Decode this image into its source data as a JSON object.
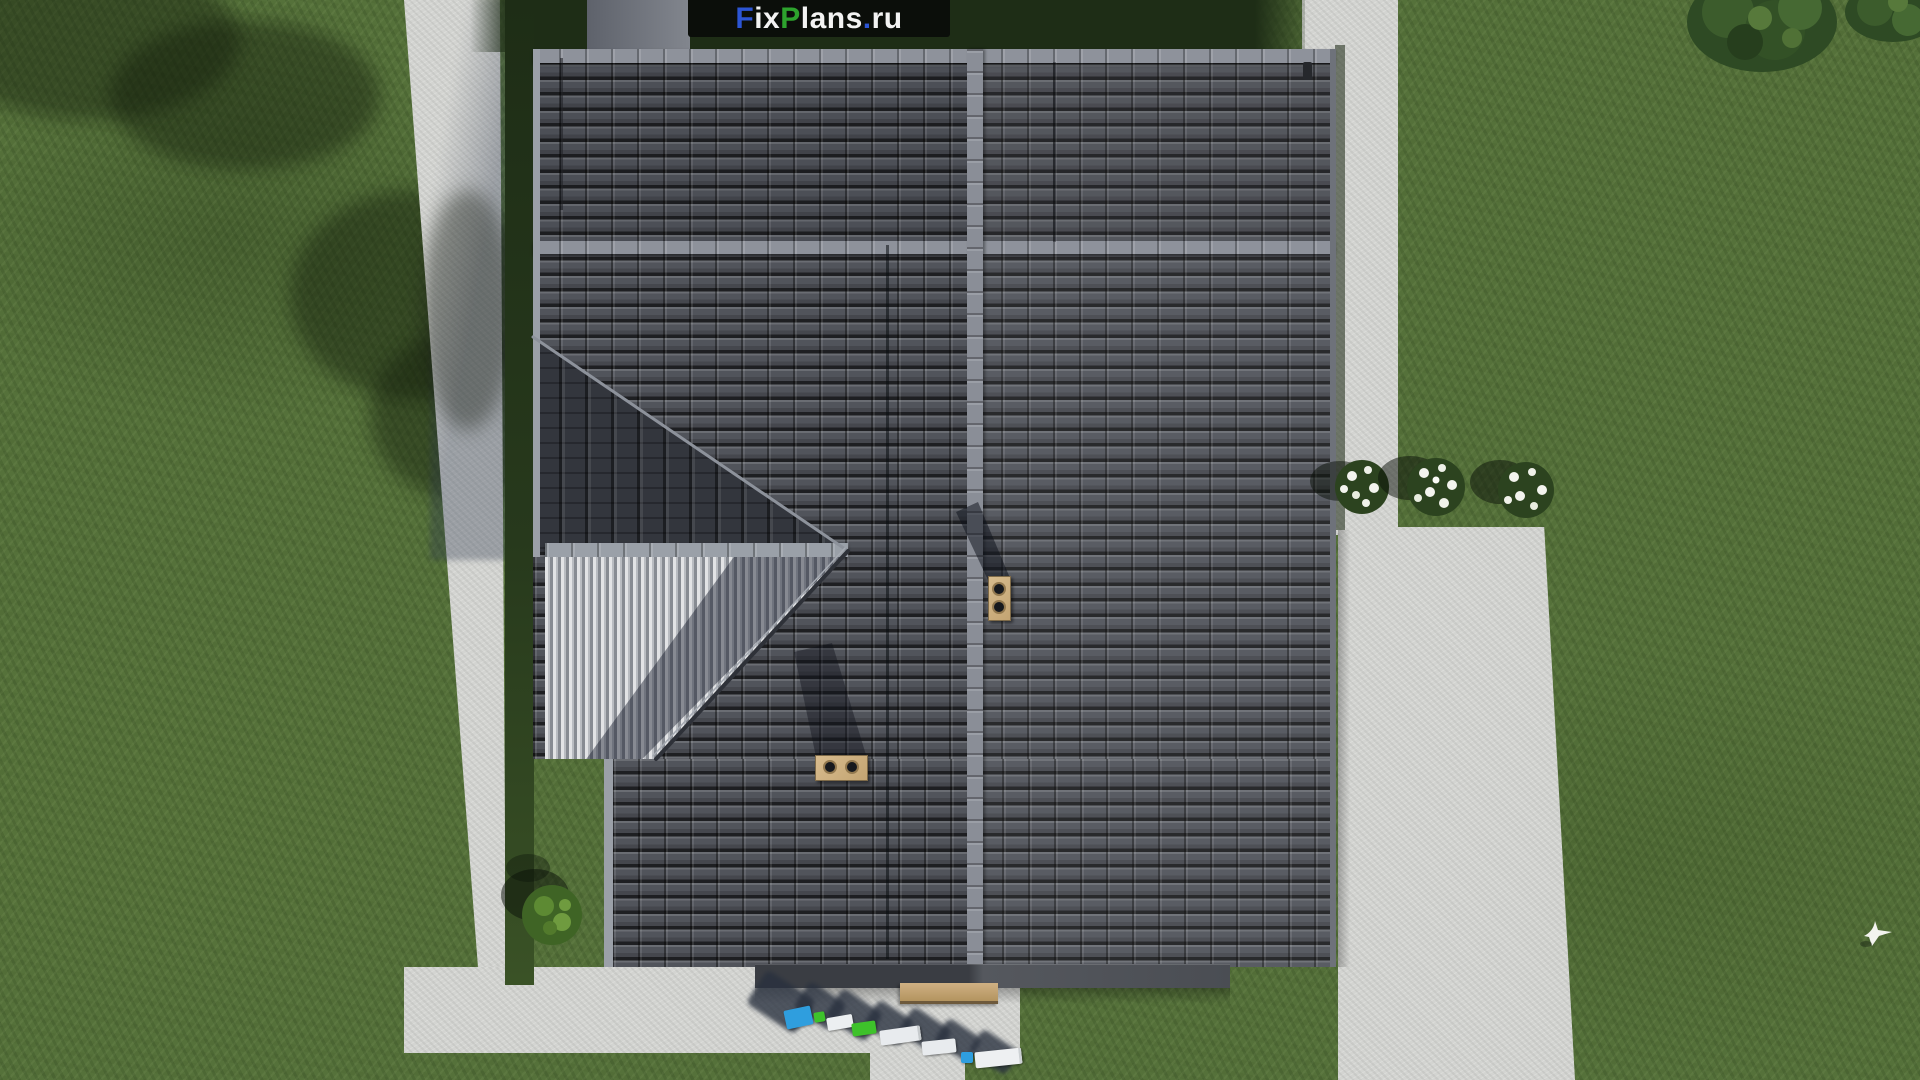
{
  "logo": {
    "full_text": "FixPlans.ru",
    "background": "#0b0e0a",
    "segments": [
      {
        "text": "F",
        "color": "#2c55d4"
      },
      {
        "text": "ix",
        "color": "#f3f3f3"
      },
      {
        "text": "P",
        "color": "#2da32d"
      },
      {
        "text": "lans",
        "color": "#f3f3f3"
      },
      {
        "text": ".",
        "color": "#2c55d4"
      },
      {
        "text": "ru",
        "color": "#f3f3f3"
      }
    ]
  },
  "scene": {
    "view": "top-down aerial render of a house roof plan",
    "palette": {
      "grass": "#55713a",
      "grass_shadow": "#1e2d16",
      "path_concrete": "#d3d4d1",
      "top_walkway": "#7e828a",
      "roof_tile": "#4e5158",
      "roof_tile_gap": "#26282c",
      "ridge_cap": "#8e929b",
      "porch_roof_ribs": "#c9cbce",
      "side_wing_shadow": "#33363d",
      "eave_fascia": "#42454b",
      "chimney": "#cdb183",
      "chimney_flue": "#17191d",
      "bench": "#c3a374",
      "foliage": "#2e4a24",
      "flowers": "#f3f4ee",
      "bird": "#f3f4ef",
      "object_blue": "#2f9ede",
      "object_green": "#3ec22b",
      "object_white": "#edeff1"
    },
    "objects": {
      "roof_sections": [
        "upper-slope",
        "main-slope",
        "side-wing-slope-in-shadow",
        "white-ribbed-porch-roof",
        "lower-slope"
      ],
      "chimneys": [
        {
          "label": "chimney-with-two-flues",
          "position": "center-right on vertical ridge"
        },
        {
          "label": "chimney-with-two-flues",
          "position": "lower-center slope"
        }
      ],
      "paths": [
        "left-vertical-path",
        "top-walkway",
        "top-right-path-strip",
        "right-large-path",
        "bottom-path-band",
        "front-walkway"
      ],
      "vegetation": {
        "flower_bushes_right": 3,
        "tree_canopies_top_right": 2,
        "round_bush_bottom_left": 1
      },
      "extras": [
        "garden-bench-at-entrance",
        "row-of-small-colored-objects-with-long-shadows",
        "white-bird-on-lawn"
      ]
    }
  }
}
